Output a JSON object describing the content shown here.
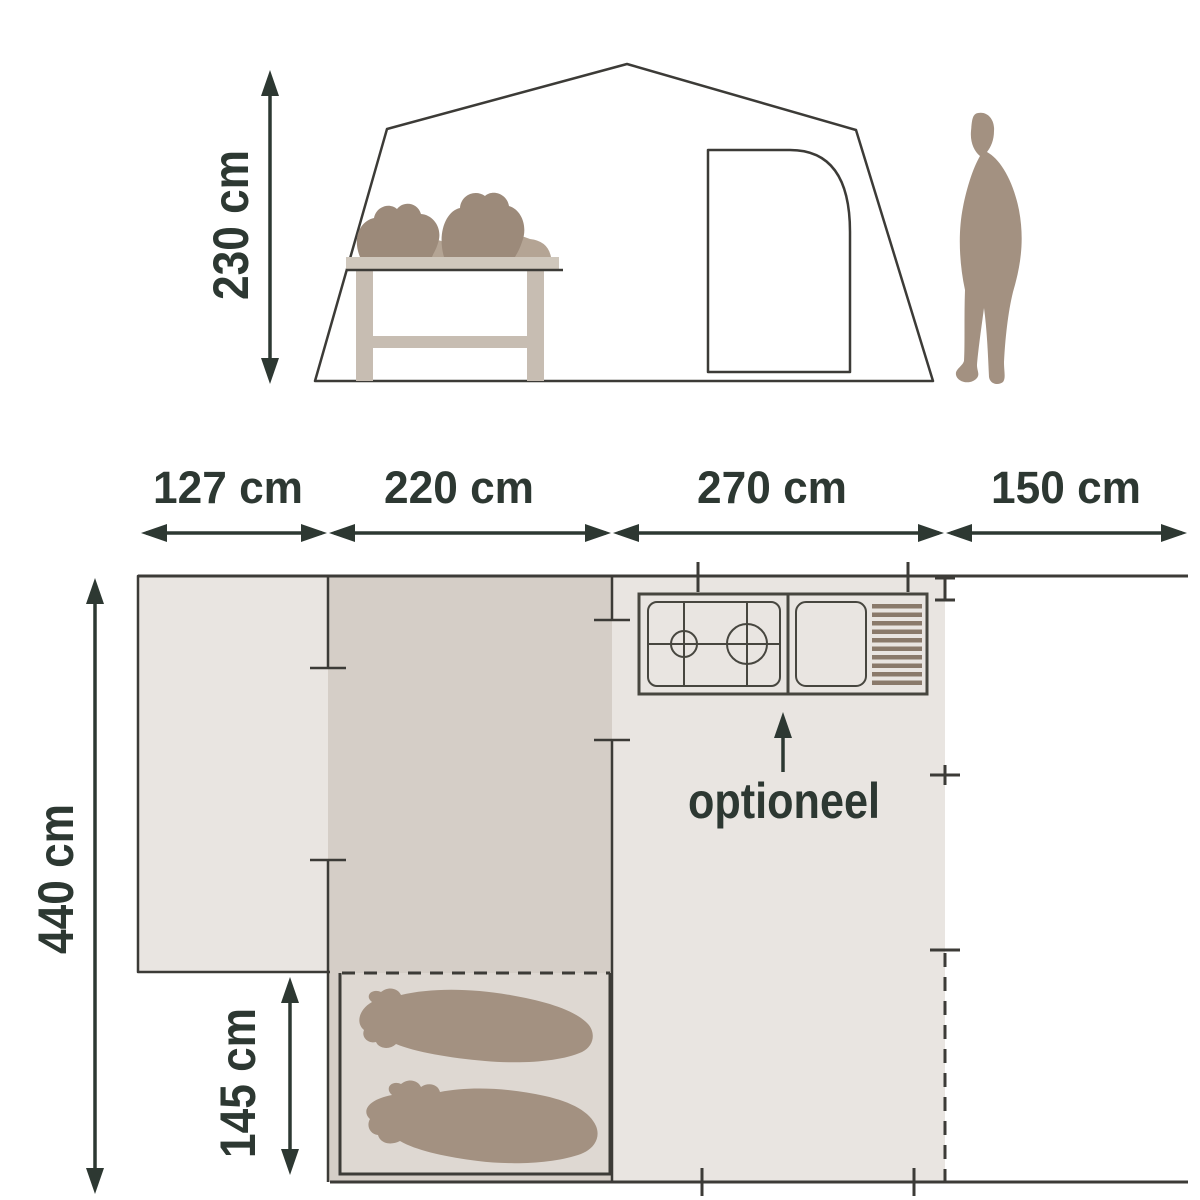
{
  "side_view": {
    "height": "230 cm"
  },
  "plan": {
    "widths": [
      "127 cm",
      "220 cm",
      "270 cm",
      "150 cm"
    ],
    "depth": "440 cm",
    "bed_width": "145 cm",
    "kitchen_note": "optioneel"
  },
  "colors": {
    "canvas": "#e9e5e1",
    "door": "#ebe8e4",
    "area_dark": "#d5cec7",
    "cabin": "#ded8d2",
    "taupe": "#a39181",
    "taupe_dark": "#9c8a7a",
    "taupe_light": "#b4a494",
    "wood": "#c7bdb2",
    "wood_light": "#cfc7bc",
    "tray": "#cbc4bd",
    "stripe": "#8a7a6b",
    "line": "#3c3b37",
    "dimension": "#2d3832"
  }
}
